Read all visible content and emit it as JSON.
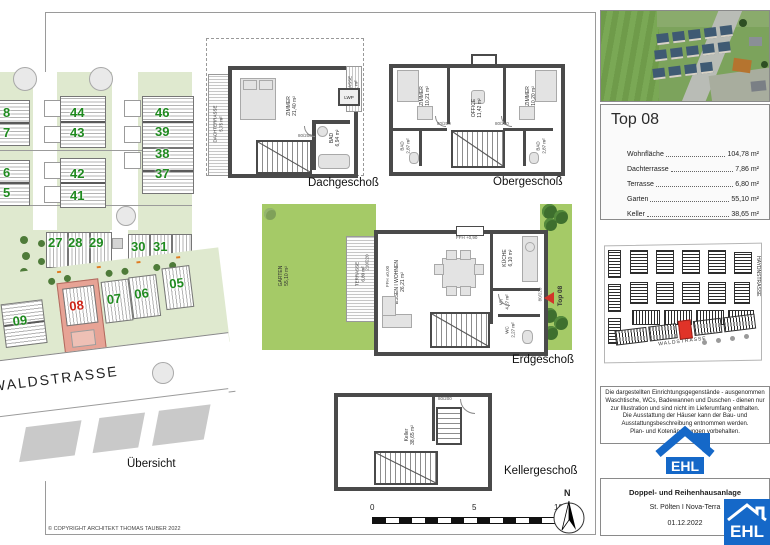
{
  "sheet": {
    "copyright": "© COPYRIGHT ARCHITEKT THOMAS TAUBER 2022",
    "overview_label": "Übersicht",
    "street": "WALDSTRASSE"
  },
  "site_plan": {
    "left_numbers": [
      "8",
      "7",
      "6",
      "5"
    ],
    "center_numbers": [
      "44",
      "43",
      "42",
      "41"
    ],
    "right_numbers": [
      "46",
      "39",
      "38",
      "37"
    ],
    "row_upper": [
      "27",
      "28",
      "29",
      "30",
      "31"
    ],
    "row_lower": [
      "09",
      "08",
      "07",
      "06",
      "05"
    ],
    "highlighted_plot": "08",
    "highlight_fill": "#e7a395",
    "number_color": "#1f8a1f",
    "highlight_number_color": "#cd2418"
  },
  "floors": {
    "dach": {
      "caption": "Dachgeschoß",
      "rooms": {
        "zimmer": {
          "name": "ZIMMER",
          "area": "21,40 m²"
        },
        "bad": {
          "name": "BAD",
          "area": "6,94 m²"
        },
        "dachterrasse": {
          "name": "DACHTERRASSE",
          "area": "5,75 m²"
        },
        "terrasse": {
          "name": "TERRASSE",
          "area": "2,11 m²"
        }
      },
      "annotations": {
        "lwp": "LWP",
        "door": "80/200"
      }
    },
    "ober": {
      "caption": "Obergeschoß",
      "rooms": {
        "zimmer_links": {
          "name": "ZIMMER",
          "area": "10,21 m²"
        },
        "office": {
          "name": "OFFICE",
          "area": "11,42 m²"
        },
        "zimmer_rechts": {
          "name": "ZIMMER",
          "area": "10,20 m²"
        },
        "bad_links": {
          "name": "BAD",
          "area": "2,87 m²"
        },
        "bad_rechts": {
          "name": "BAD",
          "area": "2,87 m²"
        }
      },
      "annotations": {
        "ffh": "FFH +0,90",
        "door_links": "80/200",
        "door_rechts": "80/200"
      }
    },
    "erd": {
      "caption": "Erdgeschoß",
      "rooms": {
        "wohnen": {
          "name": "ESSEN I WOHNEN",
          "area": "26,21 m²"
        },
        "kueche": {
          "name": "KÜCHE",
          "area": "6,10 m²"
        },
        "vr": {
          "name": "VR",
          "area": "4,27 m²"
        },
        "wc": {
          "name": "WC",
          "area": "2,27 m²"
        },
        "terrasse": {
          "name": "TERRASSE",
          "area": "6,80 m²"
        },
        "garten": {
          "name": "GARTEN",
          "area": "55,10 m²"
        }
      },
      "annotations": {
        "entrance": "Top 08",
        "ffh_fenster": "FFH +0,90",
        "ffh_tuer": "FFH ±0,00",
        "tuer_terrasse": "210/220",
        "tuer_eingang": "80/220"
      }
    },
    "keller": {
      "caption": "Kellergeschoß",
      "rooms": {
        "keller": {
          "name": "Keller",
          "area": "38,65 m²"
        }
      },
      "annotations": {
        "door": "80/200"
      }
    }
  },
  "scalebar": {
    "zero": "0",
    "five": "5",
    "ten": "10 m"
  },
  "north": {
    "label": "N"
  },
  "info_panel": {
    "title": "Top 08",
    "rows": [
      {
        "label": "Wohnfläche",
        "value": "104,78 m²"
      },
      {
        "label": "Dachterrasse",
        "value": "7,86 m²"
      },
      {
        "label": "Terrasse",
        "value": "6,80 m²"
      },
      {
        "label": "Garten",
        "value": "55,10 m²"
      },
      {
        "label": "Keller",
        "value": "38,65 m²"
      }
    ]
  },
  "location_map": {
    "street_bottom": "WALDSTRASSE",
    "street_right": "HAYDNSTRASSE",
    "highlight_color": "#e03328"
  },
  "disclaimer": {
    "p1": "Die dargestellten Einrichtungsgegenstände - ausgenommen Waschtische, WCs, Badewannen und Duschen - dienen nur zur Illustration und sind nicht im Lieferumfang enthalten.",
    "p2": "Die Ausstattung der Häuser kann der Bau- und Ausstattungsbeschreibung entnommen werden.",
    "p3": "Plan- und Kotenänderungen vorbehalten."
  },
  "footer": {
    "line1": "Doppel- und Reihenhausanlage",
    "line2": "St. Pölten I Nova-Terra",
    "line3": "01.12.2022"
  },
  "brand": {
    "name": "EHL",
    "blue": "#1568c8"
  }
}
